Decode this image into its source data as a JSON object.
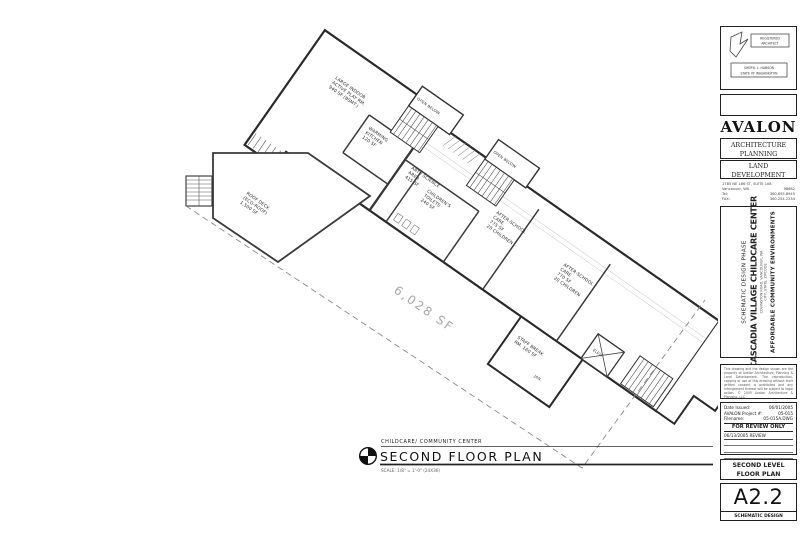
{
  "plan_title": {
    "subtitle": "CHILDCARE/ COMMUNITY CENTER",
    "title": "SECOND FLOOR PLAN",
    "scale": "SCALE: 1/8\" = 1'-0\"  (24X36)"
  },
  "plan": {
    "total_area": "6,028 SF",
    "rooms": [
      {
        "name": "large-indoor-active-play",
        "lines": [
          "LARGE INDOOR",
          "ACTIVE PLAY RM.",
          "940 SF (BSMT.)"
        ]
      },
      {
        "name": "warming-kitchen",
        "lines": [
          "WARMING",
          "KITCHEN",
          "120 SF"
        ]
      },
      {
        "name": "childrens-toilets",
        "lines": [
          "CHILDREN'S",
          "TOILETS",
          "240 SF"
        ]
      },
      {
        "name": "art-science-area",
        "lines": [
          "ART / SCIENCE",
          "AREA",
          "415 SF"
        ]
      },
      {
        "name": "after-school-care-1",
        "lines": [
          "AFTER-SCHOOL",
          "CARE",
          "775 SF",
          "20 CHILDREN"
        ]
      },
      {
        "name": "after-school-care-2",
        "lines": [
          "AFTER-SCHOOL",
          "CARE",
          "770 SF",
          "20 CHILDREN"
        ]
      },
      {
        "name": "staff-break-room",
        "lines": [
          "STAFF BREAK",
          "RM.  160 SF"
        ]
      },
      {
        "name": "janitor-closet",
        "lines": [
          "JAN."
        ]
      },
      {
        "name": "elevator",
        "lines": [
          "ELEV."
        ]
      },
      {
        "name": "roof-deck",
        "lines": [
          "ROOF DECK",
          "(ECO-ROOF)",
          "1,500 SF"
        ]
      },
      {
        "name": "open-below-1",
        "lines": [
          "OPEN BELOW"
        ]
      },
      {
        "name": "open-below-2",
        "lines": [
          "OPEN BELOW"
        ]
      }
    ]
  },
  "architect_stamp": {
    "line1": "REGISTERED",
    "line2": "ARCHITECT",
    "name": "SHERYL L. HANSON",
    "state": "STATE OF WASHINGTON"
  },
  "firm": {
    "name": "AVALON",
    "discipline1": "ARCHITECTURE",
    "discipline2": "PLANNING",
    "discipline3": "LAND",
    "discipline4": "DEVELOPMENT",
    "address1": "1785 NE 186 ST, SUITE 108",
    "city": "Vancouver, WA",
    "zip": "98682",
    "tel_label": "Tel:",
    "tel": "360.695.8945",
    "fax_label": "FAX:",
    "fax": "360.254.2234"
  },
  "project": {
    "phase": "SCHEMATIC DESIGN PHASE",
    "name": "CASCADIA VILLAGE CHILDCARE CENTER",
    "address1": "COVINGTON ROAD, VANCOUVER, WA",
    "address2": "CITY, STATE, ZIPCODE",
    "client": "AFFORDABLE COMMUNITY ENVIRONMENTS"
  },
  "disclaimer": "This drawing and the design shown are the property of Avalon Architecture, Planning & Land Development. The reproduction, copying or use of this drawing without their written consent is prohibited and any infringement thereof will be subject to legal action. © 2005 Avalon Architecture & Planning, LLC",
  "issue": {
    "date_label": "Date Issued:",
    "date": "06/01/2005",
    "project_label": "AVALON Project #:",
    "project_no": "05-015",
    "file_label": "Filename:",
    "file": "05-015A.DWG",
    "review": "FOR REVIEW ONLY",
    "revision": "06/13/2005  REVIEW"
  },
  "sheet": {
    "title_line1": "SECOND LEVEL",
    "title_line2": "FLOOR PLAN",
    "number": "A2.2",
    "phase": "SCHEMATIC DESIGN"
  }
}
